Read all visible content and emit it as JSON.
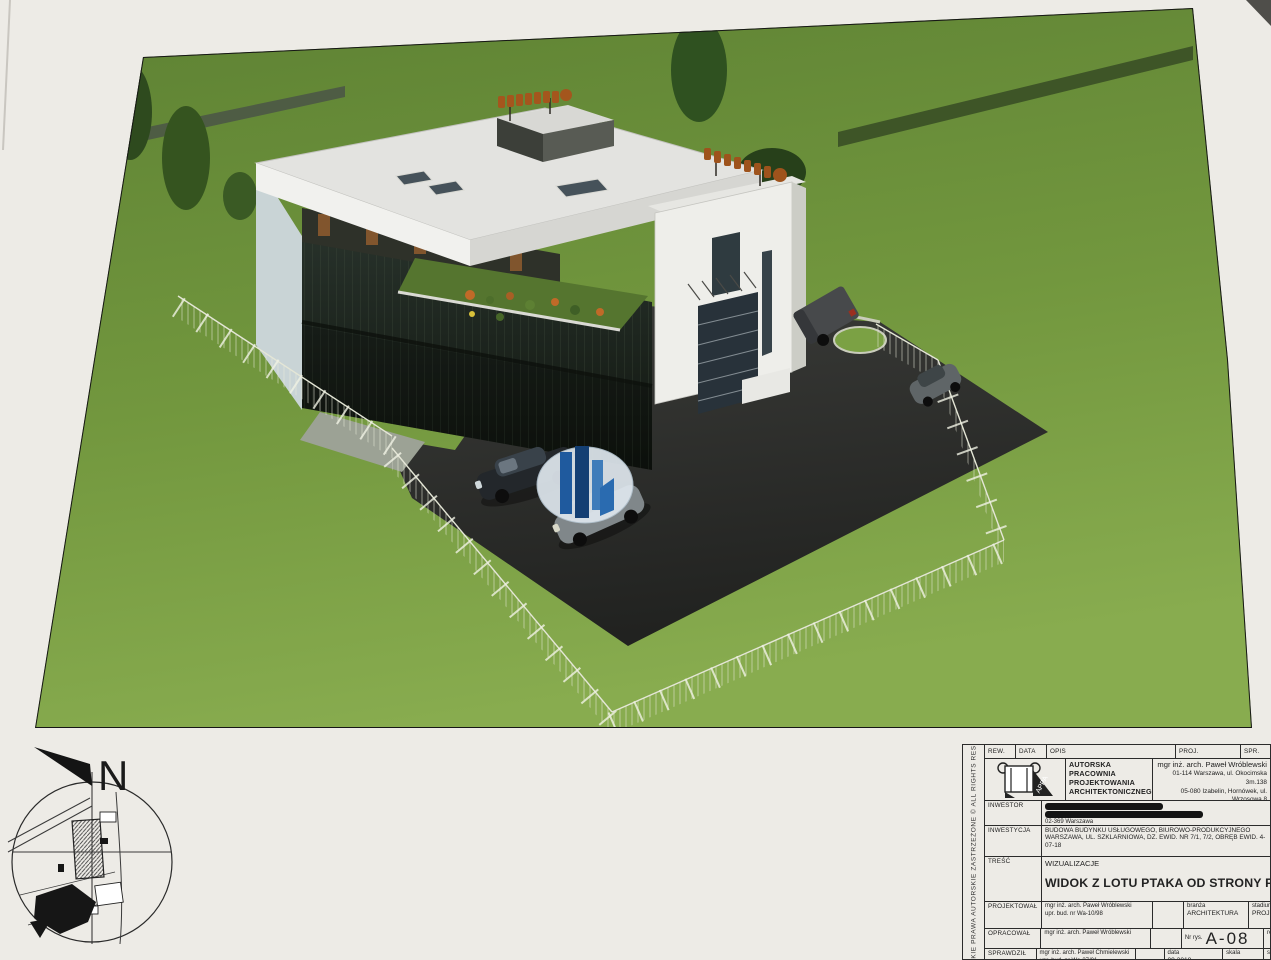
{
  "sheet": {
    "copyright_vertical": "WSZELKIE PRAWA AUTORSKIE ZASTRZEŻONE © ALL RIGHTS RESERVED",
    "compass_north_label": "N"
  },
  "title_block": {
    "header": {
      "rew": "REW.",
      "data": "DATA",
      "opis": "OPIS",
      "proj": "PROJ.",
      "spr": "SPR."
    },
    "firm": {
      "logo_text": "APPA",
      "name_line1": "AUTORSKA",
      "name_line2": "PRACOWNIA",
      "name_line3": "PROJEKTOWANIA",
      "name_line4": "ARCHITEKTONICZNEGO",
      "author": "mgr inż. arch. Paweł Wróblewski",
      "address_line1": "01-114 Warszawa, ul. Okocimska 3m.138",
      "address_line2": "05-080 Izabelin, Hornówek, ul. Wrzosowa 8",
      "phone": "tel: 22 722 66 72, 502 339 681"
    },
    "inwestor": {
      "label": "INWESTOR",
      "city": "02-369 Warszawa"
    },
    "inwestycja": {
      "label": "INWESTYCJA",
      "line1": "BUDOWA BUDYNKU USŁUGOWEGO, BIUROWO-PRODUKCYJNEGO",
      "line2": "WARSZAWA, UL. SZKLARNIOWA, DZ. EWID. NR 7/1, 7/2, OBRĘB EWID. 4-07-18"
    },
    "tresc": {
      "label": "TREŚĆ",
      "subtitle": "WIZUALIZACJE",
      "title": "WIDOK Z LOTU PTAKA OD STRONY PŁD.-ZACHODNIEJ"
    },
    "projektowal": {
      "label": "PROJEKTOWAŁ",
      "name": "mgr inż. arch. Paweł Wróblewski",
      "upr": "upr. bud. nr Wa-10/98"
    },
    "opracowal": {
      "label": "OPRACOWAŁ",
      "name": "mgr inż. arch. Paweł Wróblewski"
    },
    "sprawdzil": {
      "label": "SPRAWDZIŁ",
      "name": "mgr inż. arch. Paweł Chmielewski",
      "upr": "upr. bud. nr Wa-37/01"
    },
    "branza": {
      "label": "branża",
      "value": "ARCHITEKTURA"
    },
    "stadium": {
      "label": "stadium",
      "value": "PROJEKT KONCEPC."
    },
    "nr_rys": {
      "label": "Nr rys.",
      "value": "A-08"
    },
    "data_field": {
      "label": "data",
      "value": "09.2018"
    },
    "skala": {
      "label": "skala",
      "value": ""
    },
    "rew_col": "rew",
    "str_col": "str"
  },
  "colors": {
    "grass": "#7aa044",
    "asphalt": "#2c2d2b",
    "sign_orange": "#a4561d",
    "logo_blue": "#1f5a9e",
    "sheet": "#edebe6"
  }
}
